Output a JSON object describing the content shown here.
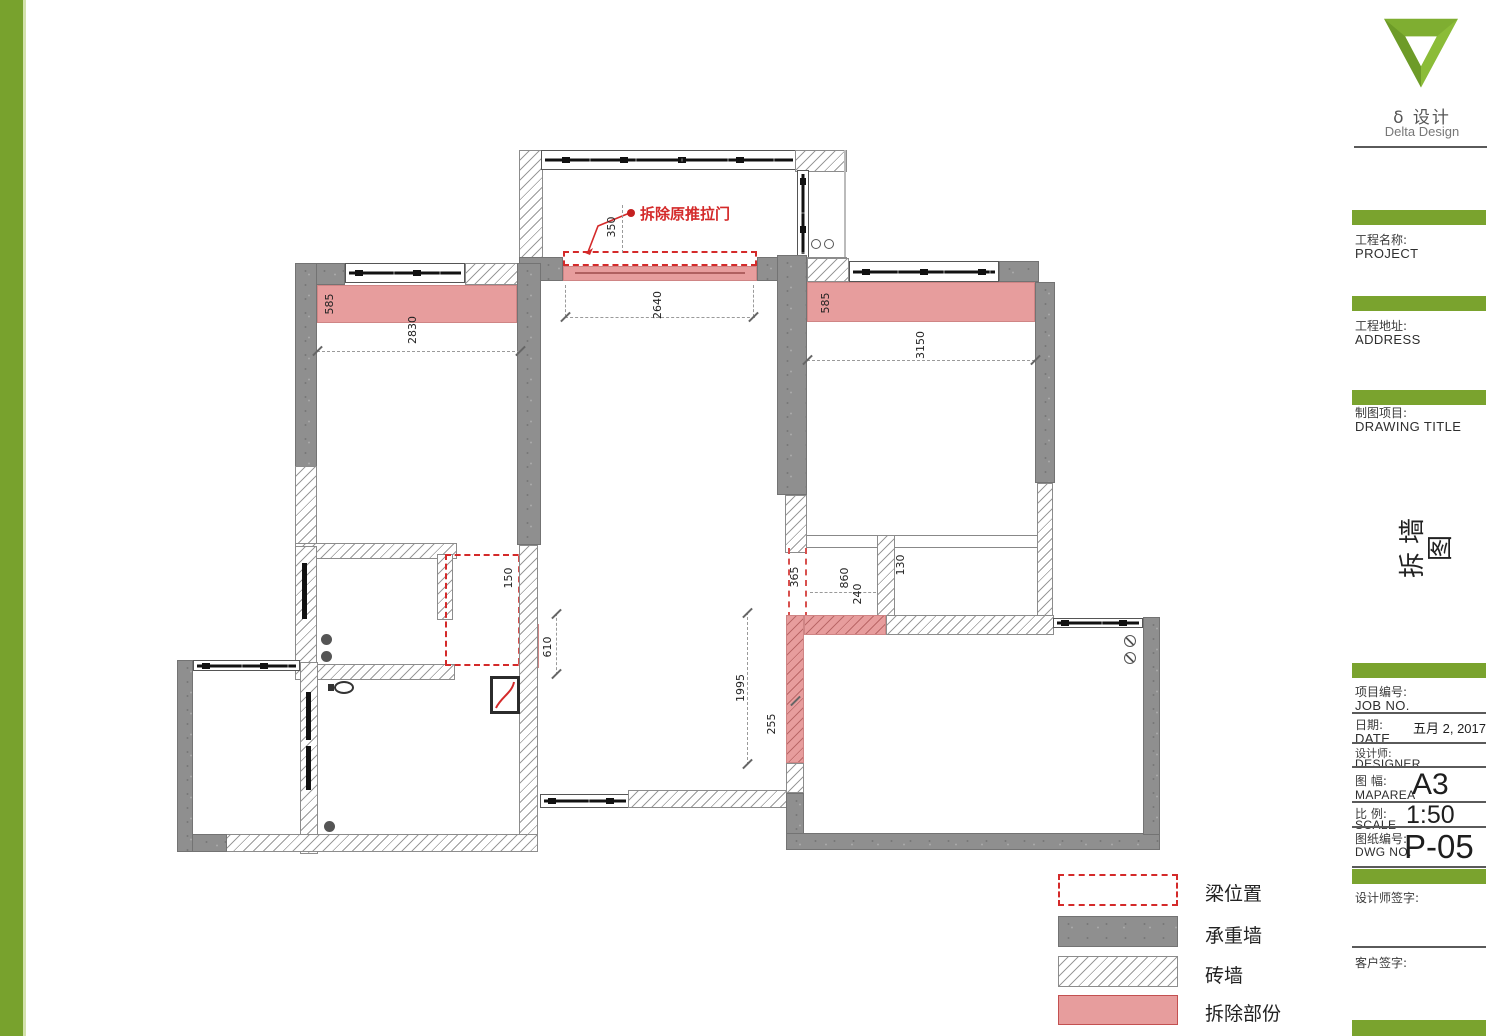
{
  "brand": {
    "logo_text_cn": "δ 设计",
    "logo_text_en": "Delta Design"
  },
  "title_block": {
    "project": {
      "label_cn": "工程名称:",
      "label_en": "PROJECT"
    },
    "address": {
      "label_cn": "工程地址:",
      "label_en": "ADDRESS"
    },
    "drawing": {
      "label_cn": "制图项目:",
      "label_en": "DRAWING TITLE"
    },
    "drawing_title_vertical": "拆墙图",
    "job": {
      "label_cn": "项目编号:",
      "label_en": "JOB NO."
    },
    "date": {
      "label_cn": "日期:",
      "label_en": "DATE",
      "value": "五月 2, 2017"
    },
    "designer": {
      "label_cn": "设计师:",
      "label_en": "DESIGNER"
    },
    "map_area": {
      "label_cn": "图 幅:",
      "label_en": "MAPAREA",
      "value": "A3"
    },
    "scale": {
      "label_cn": "比 例:",
      "label_en": "SCALE",
      "value": "1:50"
    },
    "dwg_no": {
      "label_cn": "图纸编号:",
      "label_en": "DWG NO.",
      "value": "P-05"
    },
    "designer_sign_label": "设计师签字:",
    "client_sign_label": "客户签字:"
  },
  "legend": {
    "items": [
      {
        "key": "beam",
        "label": "梁位置"
      },
      {
        "key": "load-bearing",
        "label": "承重墙"
      },
      {
        "key": "brick",
        "label": "砖墙"
      },
      {
        "key": "demolition",
        "label": "拆除部份"
      }
    ]
  },
  "plan": {
    "annotation_demolish_door": "拆除原推拉门",
    "dims": {
      "d350": "350",
      "d2640": "2640",
      "d585a": "585",
      "d2830": "2830",
      "d585b": "585",
      "d3150": "3150",
      "d150": "150",
      "d610": "610",
      "d365": "365",
      "d860": "860",
      "d240": "240",
      "d130": "130",
      "d1995": "1995",
      "d255": "255"
    }
  },
  "colors": {
    "accent_green": "#7aa32e",
    "beam_red": "#d42a2a",
    "demolition_pink": "#e79d9d",
    "wall_gray": "#8f8f8f"
  }
}
